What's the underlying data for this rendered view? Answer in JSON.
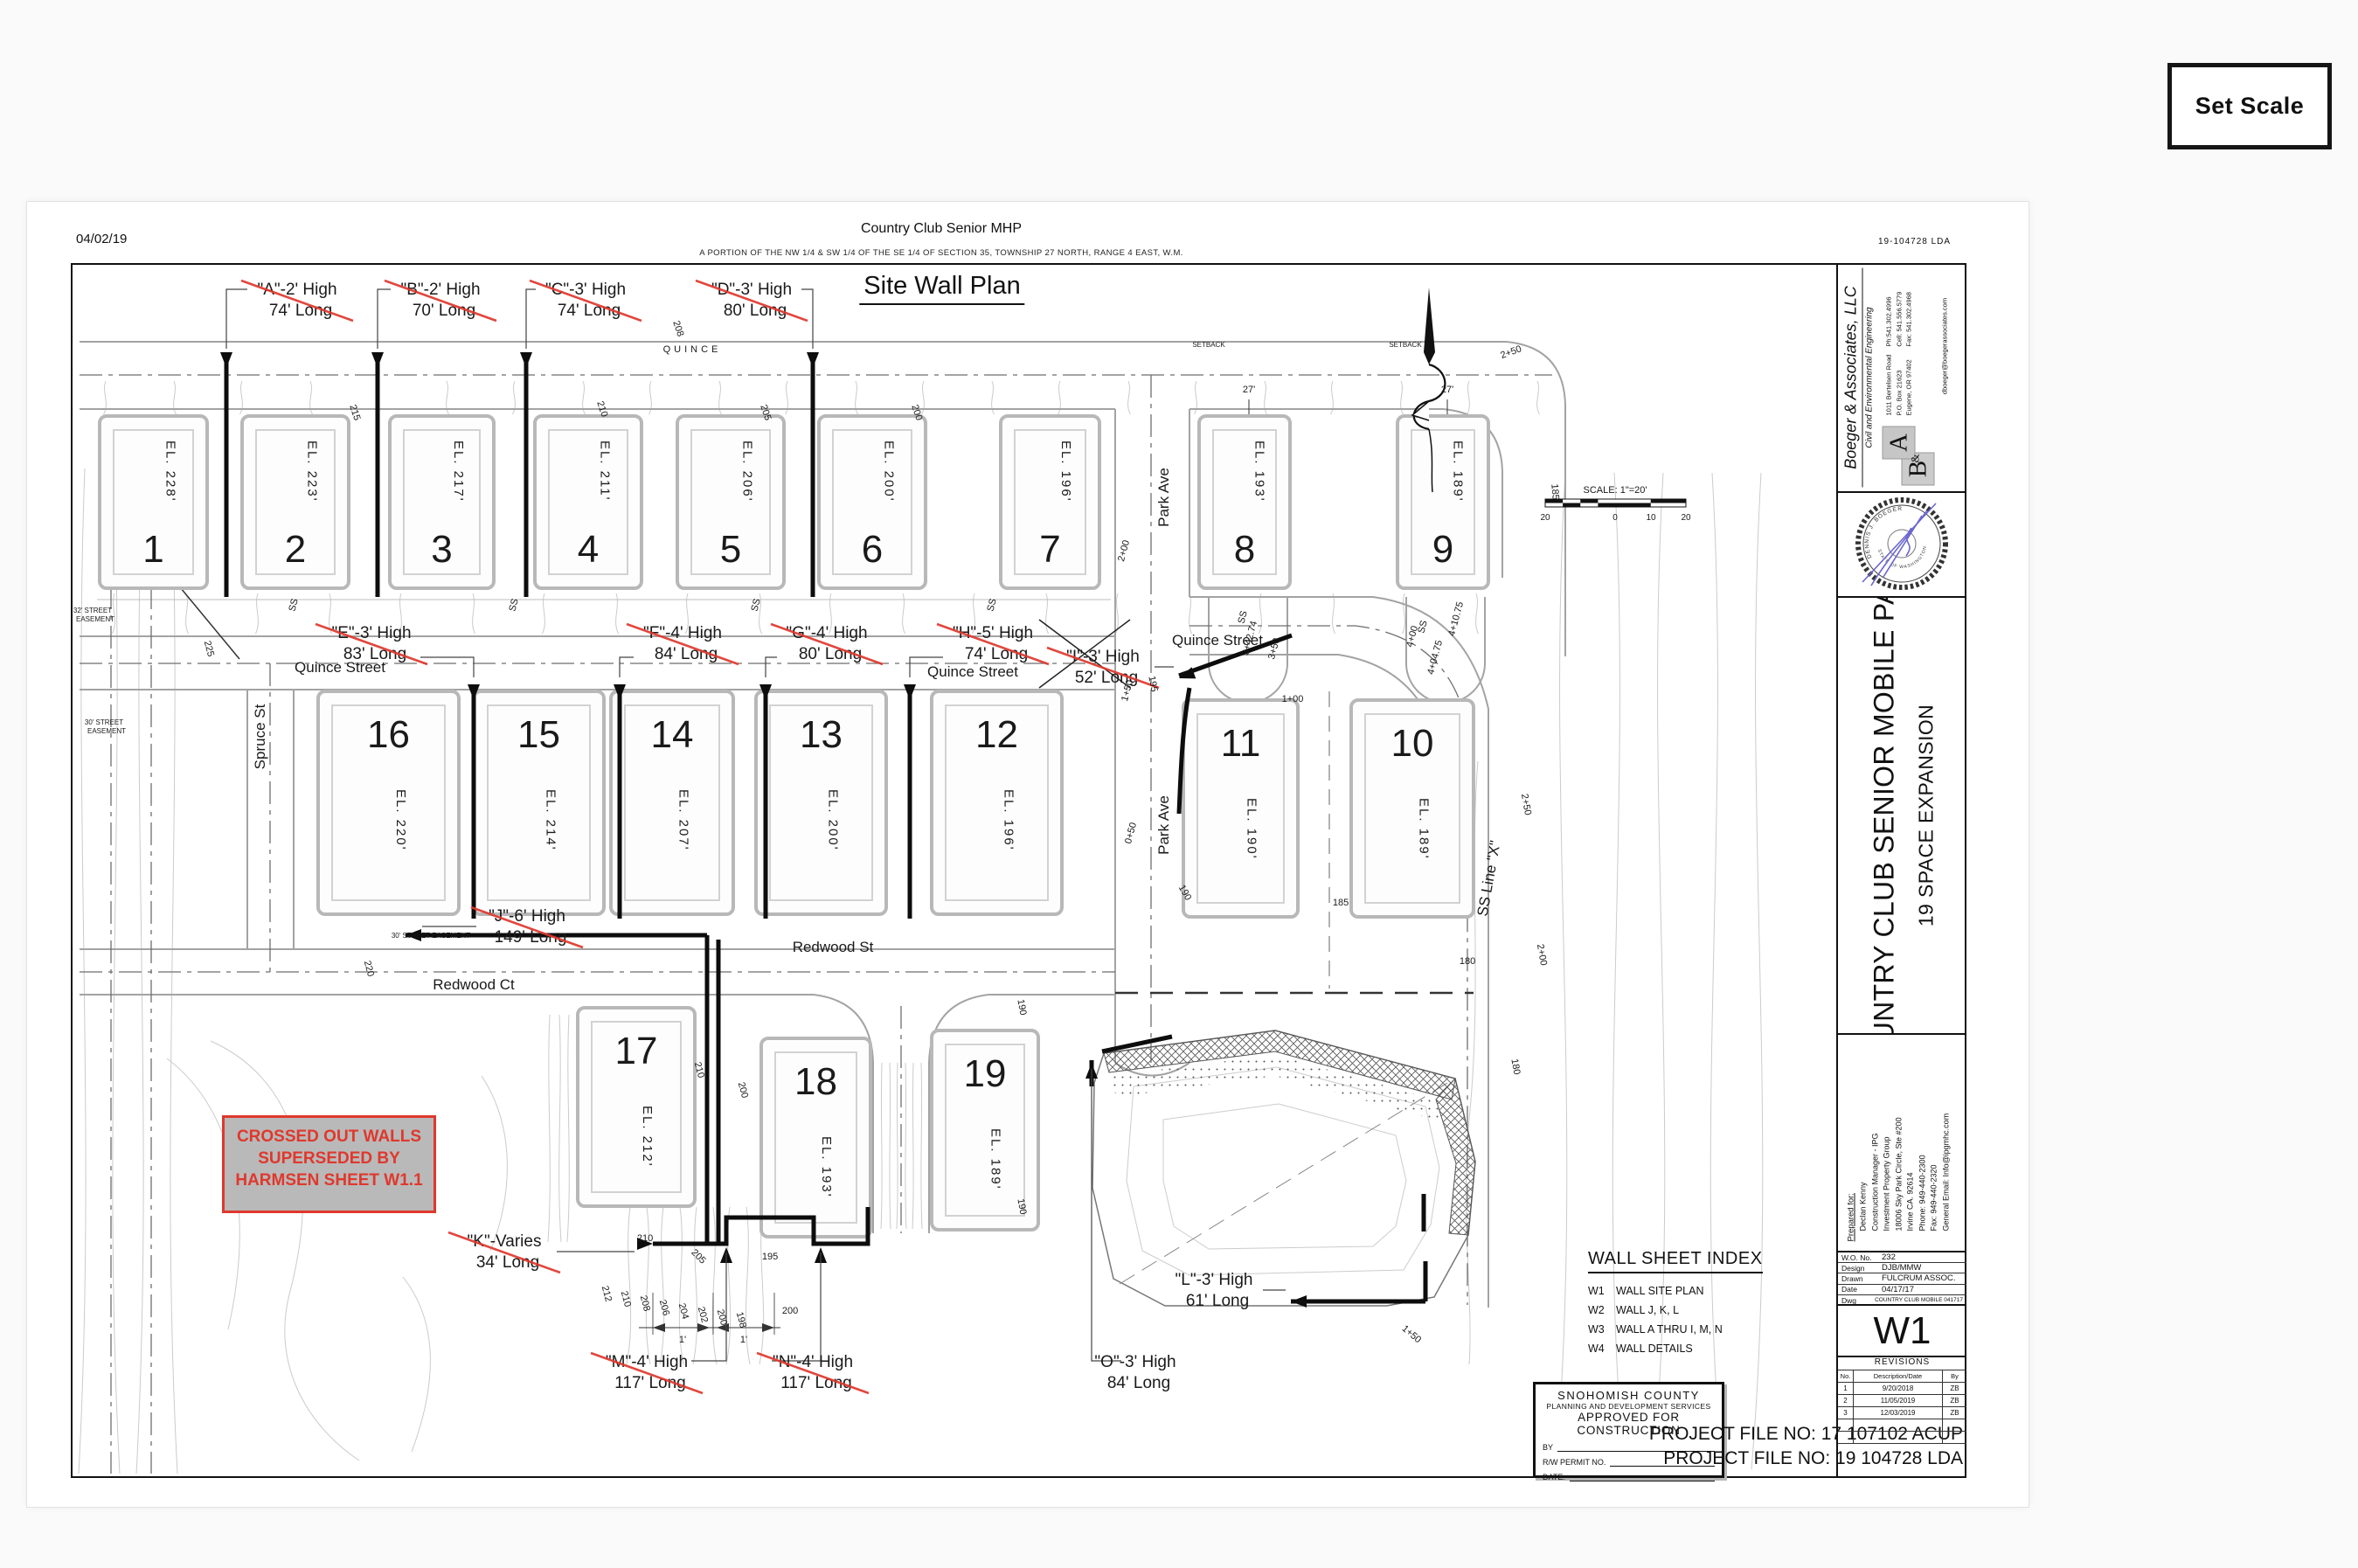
{
  "ui": {
    "set_scale": "Set Scale"
  },
  "header": {
    "date": "04/02/19",
    "lda": "19-104728 LDA",
    "title": "Country Club Senior MHP",
    "legal": "A PORTION OF THE NW 1/4 & SW 1/4 OF THE SE 1/4 OF SECTION 35, TOWNSHIP 27 NORTH, RANGE 4 EAST, W.M.",
    "plan_title": "Site Wall Plan"
  },
  "walls": [
    {
      "id": "A",
      "label": "\"A\"-2' High",
      "length": "74' Long",
      "crossed": true
    },
    {
      "id": "B",
      "label": "\"B\"-2' High",
      "length": "70' Long",
      "crossed": true
    },
    {
      "id": "C",
      "label": "\"C\"-3' High",
      "length": "74' Long",
      "crossed": true
    },
    {
      "id": "D",
      "label": "\"D\"-3' High",
      "length": "80' Long",
      "crossed": true
    },
    {
      "id": "E",
      "label": "\"E\"-3' High",
      "length": "83' Long",
      "crossed": true
    },
    {
      "id": "F",
      "label": "\"F\"-4' High",
      "length": "84' Long",
      "crossed": true
    },
    {
      "id": "G",
      "label": "\"G\"-4' High",
      "length": "80' Long",
      "crossed": true
    },
    {
      "id": "H",
      "label": "\"H\"-5' High",
      "length": "74' Long",
      "crossed": true
    },
    {
      "id": "I",
      "label": "\"I\"-3' High",
      "length": "52' Long",
      "crossed": true
    },
    {
      "id": "J",
      "label": "\"J\"-6' High",
      "length": "149' Long",
      "crossed": true
    },
    {
      "id": "K",
      "label": "\"K\"-Varies",
      "length": "34' Long",
      "crossed": true
    },
    {
      "id": "L",
      "label": "\"L\"-3' High",
      "length": "61' Long",
      "crossed": false
    },
    {
      "id": "M",
      "label": "\"M\"-4' High",
      "length": "117' Long",
      "crossed": true
    },
    {
      "id": "N",
      "label": "\"N\"-4' High",
      "length": "117' Long",
      "crossed": true
    },
    {
      "id": "O",
      "label": "\"O\"-3' High",
      "length": "84' Long",
      "crossed": false
    }
  ],
  "lots": [
    {
      "n": "1",
      "el": "EL. 228'"
    },
    {
      "n": "2",
      "el": "EL. 223'"
    },
    {
      "n": "3",
      "el": "EL. 217'"
    },
    {
      "n": "4",
      "el": "EL. 211'"
    },
    {
      "n": "5",
      "el": "EL. 206'"
    },
    {
      "n": "6",
      "el": "EL. 200'"
    },
    {
      "n": "7",
      "el": "EL. 196'"
    },
    {
      "n": "8",
      "el": "EL. 193'"
    },
    {
      "n": "9",
      "el": "EL. 189'"
    },
    {
      "n": "10",
      "el": "EL. 189'"
    },
    {
      "n": "11",
      "el": "EL. 190'"
    },
    {
      "n": "12",
      "el": "EL. 196'"
    },
    {
      "n": "13",
      "el": "EL. 200'"
    },
    {
      "n": "14",
      "el": "EL. 207'"
    },
    {
      "n": "15",
      "el": "EL. 214'"
    },
    {
      "n": "16",
      "el": "EL. 220'"
    },
    {
      "n": "17",
      "el": "EL. 212'"
    },
    {
      "n": "18",
      "el": "EL. 193'"
    },
    {
      "n": "19",
      "el": "EL. 189'"
    }
  ],
  "streets": {
    "quince_small": "QUINCE",
    "quince": "Quince Street",
    "park": "Park Ave",
    "spruce": "Spruce St",
    "redwood_ct": "Redwood Ct",
    "redwood_st": "Redwood St",
    "ss_line": "SS Line \"X\"",
    "easement32_l1": "32' STREET",
    "easement32_l2": "EASEMENT",
    "easement30_l1": "30' STREET",
    "easement30_l2": "EASEMENT",
    "easement30_l3": "30' STREET EASEMENT"
  },
  "anno": {
    "c225": "225",
    "c220": "220",
    "c215": "215",
    "c212": "212",
    "c210": "210",
    "c208": "208",
    "c206": "206",
    "c205": "205",
    "c204": "204",
    "c202": "202",
    "c200": "200",
    "c198": "198",
    "c195": "195",
    "c190": "190",
    "c185": "185",
    "c180": "180",
    "st050": "0+50",
    "st100": "1+00",
    "st150": "1+50",
    "st200": "2+00",
    "st250": "2+50",
    "st350": "3+50",
    "st400": "4+00",
    "ss34274": "3+42.74",
    "ss40475": "4+04.75",
    "ss41075": "4+10.75",
    "ss": "SS",
    "setback": "SETBACK",
    "d27": "27'",
    "d1": "1'"
  },
  "notes": {
    "box": [
      "CROSSED OUT WALLS",
      "SUPERSEDED BY",
      "HARMSEN SHEET W1.1"
    ]
  },
  "scalebar": {
    "label": "SCALE: 1\"=20'",
    "ticks": [
      "20",
      "0",
      "10",
      "20"
    ]
  },
  "wall_index": {
    "title": "WALL SHEET INDEX",
    "items": [
      {
        "code": "W1",
        "name": "WALL SITE PLAN"
      },
      {
        "code": "W2",
        "name": "WALL J, K, L"
      },
      {
        "code": "W3",
        "name": "WALL A THRU I, M, N"
      },
      {
        "code": "W4",
        "name": "WALL DETAILS"
      }
    ]
  },
  "approval": {
    "line1": "SNOHOMISH COUNTY",
    "line2": "PLANNING AND DEVELOPMENT SERVICES",
    "line3": "APPROVED FOR CONSTRUCTION",
    "by": "BY",
    "permit": "R/W PERMIT NO.",
    "date": "DATE:"
  },
  "files": [
    "PROJECT FILE NO: 17 107102 ACUP",
    "PROJECT FILE NO: 19 104728 LDA"
  ],
  "firm": {
    "name": "Boeger & Associates, LLC",
    "tagline": "Civil and Environmental Engineering",
    "addr": [
      "1011 Bertelsen Road",
      "P.O. Box 21623",
      "Eugene, OR 97402"
    ],
    "phones": [
      "Ph:541.302.4996",
      "Cell: 541.556.5779",
      "Fax: 541.302.4968"
    ],
    "email": "dboeger@boegerassociates.com",
    "logo_b": "B",
    "logo_amp": "&",
    "logo_a": "A"
  },
  "stamp": {
    "name": "DENNIS J. BOEGER",
    "state": "STATE OF WASHINGTON"
  },
  "project": {
    "name": "COUNTRY CLUB SENIOR MOBILE PARK",
    "sub": "19 SPACE EXPANSION"
  },
  "prepared": {
    "heading": "Prepared for:",
    "lines": [
      "Declan Kenny",
      "Construction Manager - IPG",
      "Investment Property Group",
      "18006 Sky Park Circle, Ste #200",
      "Irvine CA. 92614",
      "Phone: 949-440-2300",
      "Fax: 949-440-2320",
      "General Email: Info@ipgmhc.com"
    ]
  },
  "wo": [
    {
      "k": "W.O. No.",
      "v": "232"
    },
    {
      "k": "Design",
      "v": "DJB/MMW"
    },
    {
      "k": "Drawn",
      "v": "FULCRUM ASSOC."
    },
    {
      "k": "Date",
      "v": "04/17/17"
    },
    {
      "k": "Dwg",
      "v": "COUNTRY CLUB MOBILE 041717"
    }
  ],
  "sheet_no": "W1",
  "revisions": {
    "title": "REVISIONS",
    "cols": [
      "No.",
      "Description/Date",
      "By"
    ],
    "rows": [
      [
        "1",
        "9/20/2018",
        "ZB"
      ],
      [
        "2",
        "11/05/2019",
        "ZB"
      ],
      [
        "3",
        "12/03/2019",
        "ZB"
      ]
    ]
  }
}
